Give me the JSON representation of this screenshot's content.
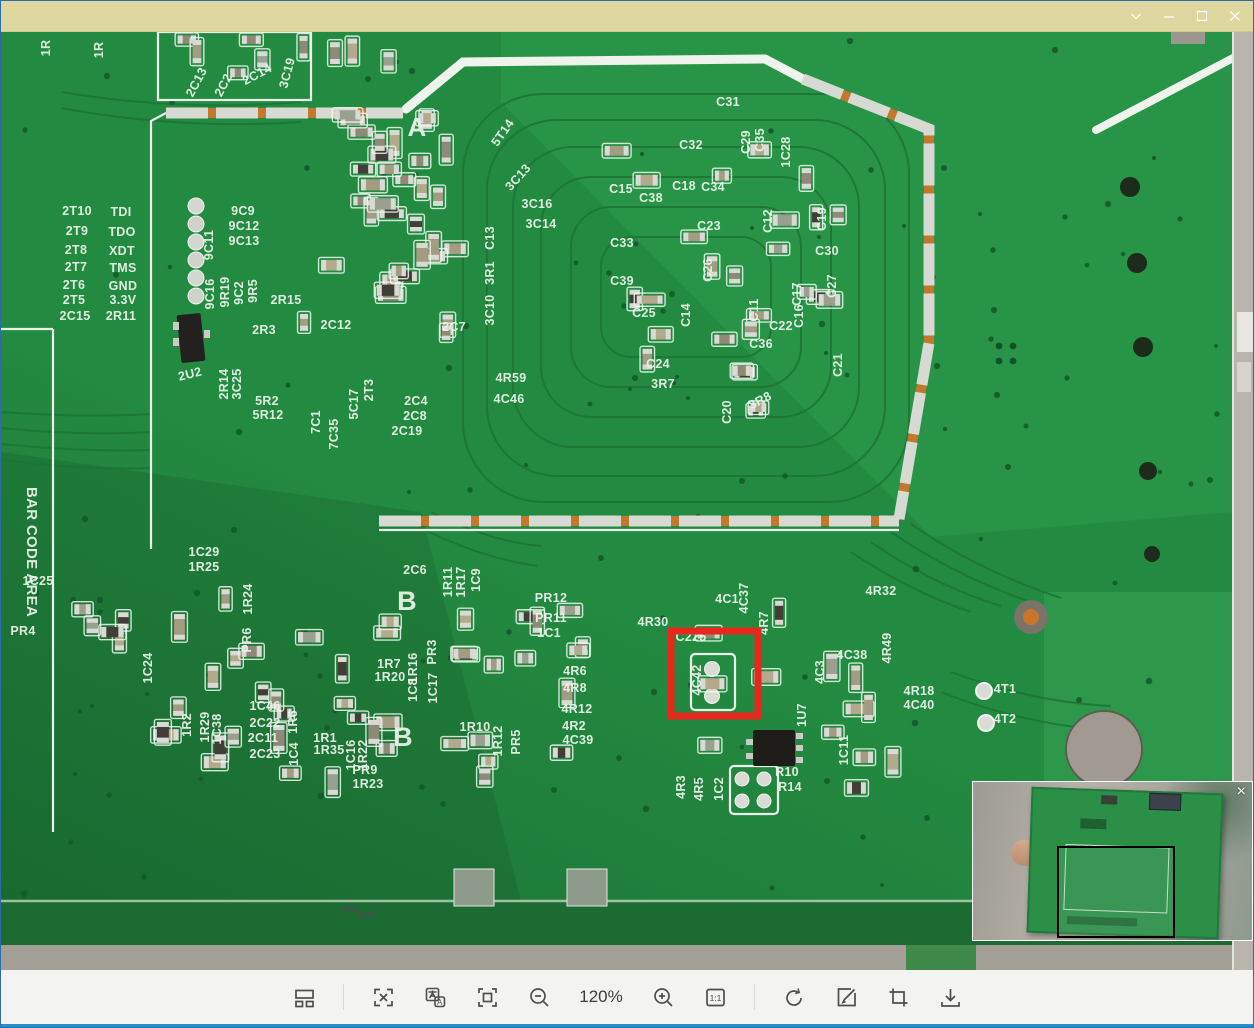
{
  "window": {
    "title": "",
    "controls": [
      {
        "name": "menu-chevron",
        "glyph": "v"
      },
      {
        "name": "minimize",
        "glyph": "—"
      },
      {
        "name": "maximize",
        "glyph": "□"
      },
      {
        "name": "close",
        "glyph": "×"
      }
    ]
  },
  "toolbar": {
    "zoom_level": "120%",
    "buttons": [
      "layout-panels",
      "ocr-extract",
      "translate",
      "fit-screen",
      "zoom-out",
      "zoom-in",
      "actual-size",
      "rotate",
      "edit",
      "crop",
      "download"
    ],
    "actual_size_label": "1:1",
    "translate_letter": "A"
  },
  "navigator": {
    "close_glyph": "×"
  },
  "pcb": {
    "annotation_color": "#e8281e",
    "red_box": {
      "x": 670,
      "y": 599,
      "w": 87,
      "h": 85
    },
    "big_letters": [
      {
        "t": "A",
        "x": 416,
        "y": 104,
        "s": 26
      },
      {
        "t": "B",
        "x": 406,
        "y": 578,
        "s": 27
      },
      {
        "t": "B",
        "x": 402,
        "y": 714,
        "s": 27
      }
    ],
    "labels": [
      {
        "t": "1R",
        "x": 49,
        "y": 16,
        "r": -90
      },
      {
        "t": "1R",
        "x": 102,
        "y": 18,
        "r": -90
      },
      {
        "t": "2C13",
        "x": 199,
        "y": 52,
        "r": -62
      },
      {
        "t": "2C2",
        "x": 226,
        "y": 55,
        "r": -62
      },
      {
        "t": "2C14",
        "x": 258,
        "y": 46,
        "r": -28
      },
      {
        "t": "3C19",
        "x": 290,
        "y": 42,
        "r": -75
      },
      {
        "t": "5T14",
        "x": 505,
        "y": 103,
        "r": -55
      },
      {
        "t": "3C13",
        "x": 520,
        "y": 148,
        "r": -48
      },
      {
        "t": "3C16",
        "x": 536,
        "y": 176
      },
      {
        "t": "3C14",
        "x": 540,
        "y": 196
      },
      {
        "t": "2T10",
        "x": 76,
        "y": 183
      },
      {
        "t": "TDI",
        "x": 120,
        "y": 184
      },
      {
        "t": "2T9",
        "x": 76,
        "y": 203
      },
      {
        "t": "TDO",
        "x": 121,
        "y": 204
      },
      {
        "t": "2T8",
        "x": 75,
        "y": 222
      },
      {
        "t": "XDT",
        "x": 121,
        "y": 223
      },
      {
        "t": "2T7",
        "x": 75,
        "y": 239
      },
      {
        "t": "TMS",
        "x": 122,
        "y": 240
      },
      {
        "t": "2T6",
        "x": 73,
        "y": 257
      },
      {
        "t": "GND",
        "x": 122,
        "y": 258
      },
      {
        "t": "2T5",
        "x": 73,
        "y": 272
      },
      {
        "t": "3.3V",
        "x": 122,
        "y": 272
      },
      {
        "t": "2C15",
        "x": 74,
        "y": 288
      },
      {
        "t": "2R11",
        "x": 120,
        "y": 288
      },
      {
        "t": "9C11",
        "x": 212,
        "y": 213,
        "r": -90
      },
      {
        "t": "9C9",
        "x": 242,
        "y": 183
      },
      {
        "t": "9C12",
        "x": 243,
        "y": 198
      },
      {
        "t": "9C13",
        "x": 243,
        "y": 213
      },
      {
        "t": "9C16",
        "x": 213,
        "y": 262,
        "r": -90
      },
      {
        "t": "9R19",
        "x": 228,
        "y": 260,
        "r": -90
      },
      {
        "t": "9C2",
        "x": 242,
        "y": 261,
        "r": -90
      },
      {
        "t": "9R5",
        "x": 256,
        "y": 259,
        "r": -90
      },
      {
        "t": "2R15",
        "x": 285,
        "y": 272
      },
      {
        "t": "2R3",
        "x": 263,
        "y": 302
      },
      {
        "t": "2C12",
        "x": 335,
        "y": 297
      },
      {
        "t": "2U2",
        "x": 190,
        "y": 346,
        "r": -14
      },
      {
        "t": "2R14",
        "x": 227,
        "y": 352,
        "r": -90
      },
      {
        "t": "3C25",
        "x": 240,
        "y": 352,
        "r": -90
      },
      {
        "t": "5R2",
        "x": 266,
        "y": 373
      },
      {
        "t": "5R12",
        "x": 267,
        "y": 387
      },
      {
        "t": "7C1",
        "x": 319,
        "y": 390,
        "r": -90
      },
      {
        "t": "7C35",
        "x": 337,
        "y": 402,
        "r": -90
      },
      {
        "t": "5C17",
        "x": 357,
        "y": 372,
        "r": -90
      },
      {
        "t": "2T3",
        "x": 372,
        "y": 358,
        "r": -90
      },
      {
        "t": "2C4",
        "x": 415,
        "y": 373
      },
      {
        "t": "2C8",
        "x": 414,
        "y": 388
      },
      {
        "t": "2C19",
        "x": 406,
        "y": 403
      },
      {
        "t": "2C7",
        "x": 453,
        "y": 299
      },
      {
        "t": "C13",
        "x": 493,
        "y": 206,
        "r": -90
      },
      {
        "t": "3R1",
        "x": 493,
        "y": 241,
        "r": -90
      },
      {
        "t": "3C10",
        "x": 493,
        "y": 278,
        "r": -90
      },
      {
        "t": "4R59",
        "x": 510,
        "y": 350
      },
      {
        "t": "4C46",
        "x": 508,
        "y": 371
      },
      {
        "t": "C31",
        "x": 727,
        "y": 74
      },
      {
        "t": "C32",
        "x": 690,
        "y": 117
      },
      {
        "t": "C29",
        "x": 749,
        "y": 110,
        "r": -90
      },
      {
        "t": "C35",
        "x": 763,
        "y": 108,
        "r": -90
      },
      {
        "t": "1C28",
        "x": 789,
        "y": 120,
        "r": -90
      },
      {
        "t": "C15",
        "x": 620,
        "y": 161
      },
      {
        "t": "C38",
        "x": 650,
        "y": 170
      },
      {
        "t": "C18",
        "x": 683,
        "y": 158
      },
      {
        "t": "C34",
        "x": 712,
        "y": 159
      },
      {
        "t": "C23",
        "x": 708,
        "y": 198
      },
      {
        "t": "C12",
        "x": 771,
        "y": 189,
        "r": -90
      },
      {
        "t": "C19",
        "x": 825,
        "y": 187,
        "r": -90
      },
      {
        "t": "C33",
        "x": 621,
        "y": 215
      },
      {
        "t": "C39",
        "x": 621,
        "y": 253
      },
      {
        "t": "C26",
        "x": 711,
        "y": 238,
        "r": -90
      },
      {
        "t": "C30",
        "x": 826,
        "y": 223
      },
      {
        "t": "C27",
        "x": 835,
        "y": 254,
        "r": -90
      },
      {
        "t": "C25",
        "x": 643,
        "y": 285
      },
      {
        "t": "C14",
        "x": 689,
        "y": 283,
        "r": -90
      },
      {
        "t": "C11",
        "x": 757,
        "y": 278,
        "r": -90
      },
      {
        "t": "C17",
        "x": 800,
        "y": 262,
        "r": -90
      },
      {
        "t": "C16",
        "x": 802,
        "y": 284,
        "r": -90
      },
      {
        "t": "C22",
        "x": 780,
        "y": 298
      },
      {
        "t": "C36",
        "x": 760,
        "y": 316
      },
      {
        "t": "C24",
        "x": 657,
        "y": 336
      },
      {
        "t": "3R7",
        "x": 662,
        "y": 356
      },
      {
        "t": "C20",
        "x": 730,
        "y": 380,
        "r": -90
      },
      {
        "t": "3R8",
        "x": 761,
        "y": 372,
        "r": -28
      },
      {
        "t": "C21",
        "x": 841,
        "y": 333,
        "r": -90
      },
      {
        "t": "1C29",
        "x": 203,
        "y": 524
      },
      {
        "t": "1R25",
        "x": 203,
        "y": 539
      },
      {
        "t": "1R24",
        "x": 251,
        "y": 567,
        "r": -90
      },
      {
        "t": "PR6",
        "x": 250,
        "y": 608,
        "r": -90
      },
      {
        "t": "1C25",
        "x": 37,
        "y": 553
      },
      {
        "t": "PR4",
        "x": 22,
        "y": 603
      },
      {
        "t": "1C24",
        "x": 151,
        "y": 636,
        "r": -90
      },
      {
        "t": "2C6",
        "x": 414,
        "y": 542
      },
      {
        "t": "1R11",
        "x": 451,
        "y": 550,
        "r": -90
      },
      {
        "t": "1R17",
        "x": 464,
        "y": 550,
        "r": -90
      },
      {
        "t": "1C9",
        "x": 479,
        "y": 548,
        "r": -90
      },
      {
        "t": "PR12",
        "x": 550,
        "y": 570
      },
      {
        "t": "PR11",
        "x": 550,
        "y": 590
      },
      {
        "t": "1C1",
        "x": 548,
        "y": 605
      },
      {
        "t": "4R30",
        "x": 652,
        "y": 594
      },
      {
        "t": "C225",
        "x": 690,
        "y": 609
      },
      {
        "t": "4C1",
        "x": 726,
        "y": 571
      },
      {
        "t": "4C37",
        "x": 747,
        "y": 566,
        "r": -90
      },
      {
        "t": "4R7",
        "x": 767,
        "y": 591,
        "r": -90
      },
      {
        "t": "4C42",
        "x": 700,
        "y": 648,
        "r": -90
      },
      {
        "t": "4R32",
        "x": 880,
        "y": 563
      },
      {
        "t": "4R49",
        "x": 890,
        "y": 616,
        "r": -90
      },
      {
        "t": "4C38",
        "x": 851,
        "y": 627
      },
      {
        "t": "4C3",
        "x": 823,
        "y": 640,
        "r": -90
      },
      {
        "t": "4R18",
        "x": 918,
        "y": 663
      },
      {
        "t": "4C40",
        "x": 918,
        "y": 677
      },
      {
        "t": "4T1",
        "x": 1004,
        "y": 661
      },
      {
        "t": "4T2",
        "x": 1004,
        "y": 691
      },
      {
        "t": "1R7",
        "x": 388,
        "y": 636
      },
      {
        "t": "1R20",
        "x": 389,
        "y": 649
      },
      {
        "t": "1R16",
        "x": 416,
        "y": 636,
        "r": -90
      },
      {
        "t": "1C8",
        "x": 416,
        "y": 658,
        "r": -90
      },
      {
        "t": "PR3",
        "x": 435,
        "y": 620,
        "r": -90
      },
      {
        "t": "1C17",
        "x": 436,
        "y": 656,
        "r": -90
      },
      {
        "t": "4R6",
        "x": 574,
        "y": 643
      },
      {
        "t": "4R8",
        "x": 574,
        "y": 660
      },
      {
        "t": "4R12",
        "x": 576,
        "y": 681
      },
      {
        "t": "4R2",
        "x": 573,
        "y": 698
      },
      {
        "t": "4C39",
        "x": 577,
        "y": 712
      },
      {
        "t": "1R10",
        "x": 474,
        "y": 699
      },
      {
        "t": "1R12",
        "x": 501,
        "y": 709,
        "r": -90
      },
      {
        "t": "PR5",
        "x": 519,
        "y": 710,
        "r": -90
      },
      {
        "t": "1R2",
        "x": 190,
        "y": 693,
        "r": -90
      },
      {
        "t": "1R29",
        "x": 208,
        "y": 695,
        "r": -90
      },
      {
        "t": "1C38",
        "x": 220,
        "y": 697,
        "r": -90
      },
      {
        "t": "1C46",
        "x": 264,
        "y": 678
      },
      {
        "t": "2C22",
        "x": 264,
        "y": 695
      },
      {
        "t": "2C11",
        "x": 262,
        "y": 710
      },
      {
        "t": "2C23",
        "x": 264,
        "y": 726
      },
      {
        "t": "1R6",
        "x": 296,
        "y": 690,
        "r": -90
      },
      {
        "t": "1C4",
        "x": 297,
        "y": 722,
        "r": -90
      },
      {
        "t": "1R1",
        "x": 324,
        "y": 710
      },
      {
        "t": "1R35",
        "x": 328,
        "y": 722
      },
      {
        "t": "1C16",
        "x": 354,
        "y": 723,
        "r": -90
      },
      {
        "t": "1R22",
        "x": 366,
        "y": 723,
        "r": -90
      },
      {
        "t": "PR9",
        "x": 364,
        "y": 742
      },
      {
        "t": "1R23",
        "x": 367,
        "y": 756
      },
      {
        "t": "1U7",
        "x": 805,
        "y": 683,
        "r": -90
      },
      {
        "t": "1C11",
        "x": 847,
        "y": 718,
        "r": -90
      },
      {
        "t": "4R3",
        "x": 684,
        "y": 755,
        "r": -90
      },
      {
        "t": "4R5",
        "x": 702,
        "y": 757,
        "r": -90
      },
      {
        "t": "1C2",
        "x": 722,
        "y": 757,
        "r": -90
      },
      {
        "t": "R10",
        "x": 786,
        "y": 744
      },
      {
        "t": "R14",
        "x": 789,
        "y": 759
      },
      {
        "t": "BAR CODE AREA",
        "x": 26,
        "y": 520,
        "r": 90,
        "s": 15
      }
    ],
    "clusters": [
      {
        "x": 295,
        "y": 62,
        "w": 175,
        "h": 250,
        "n": 34,
        "seed": 7
      },
      {
        "x": 598,
        "y": 92,
        "w": 250,
        "h": 296,
        "n": 26,
        "seed": 11
      },
      {
        "x": 150,
        "y": 555,
        "w": 270,
        "h": 212,
        "n": 26,
        "seed": 23
      },
      {
        "x": 440,
        "y": 565,
        "w": 148,
        "h": 188,
        "n": 16,
        "seed": 5
      },
      {
        "x": 690,
        "y": 560,
        "w": 215,
        "h": 218,
        "n": 13,
        "seed": 31
      },
      {
        "x": 165,
        "y": 2,
        "w": 260,
        "h": 46,
        "n": 9,
        "seed": 13
      },
      {
        "x": 62,
        "y": 568,
        "w": 85,
        "h": 58,
        "n": 5,
        "seed": 17
      }
    ]
  }
}
